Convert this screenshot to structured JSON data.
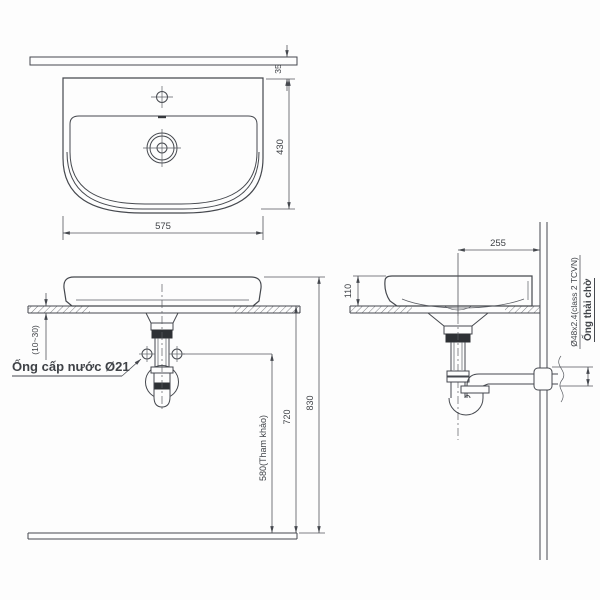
{
  "drawing": {
    "type": "washbasin installation technical drawing",
    "colors": {
      "line": "#45484e",
      "dim_line": "#53565c",
      "background": "#fdfdfd",
      "dark_fill": "#2e3135"
    }
  },
  "top_view": {
    "dim_width": "575",
    "dim_depth": "430",
    "dim_back_ledge": "35"
  },
  "front_view": {
    "dim_rim_height": "830",
    "dim_counter_height": "720",
    "dim_supply_height": "580(Tham khảo)",
    "dim_counter_thickness": "(10~30)",
    "label_water_supply": "Ống cấp nước Ø21"
  },
  "side_view": {
    "dim_drain_to_wall": "255",
    "dim_basin_height": "110",
    "label_waste_pipe_spec": "Ø48x2.4(class 2 TCVN)",
    "label_waste_pipe": "Ống thải chờ"
  }
}
